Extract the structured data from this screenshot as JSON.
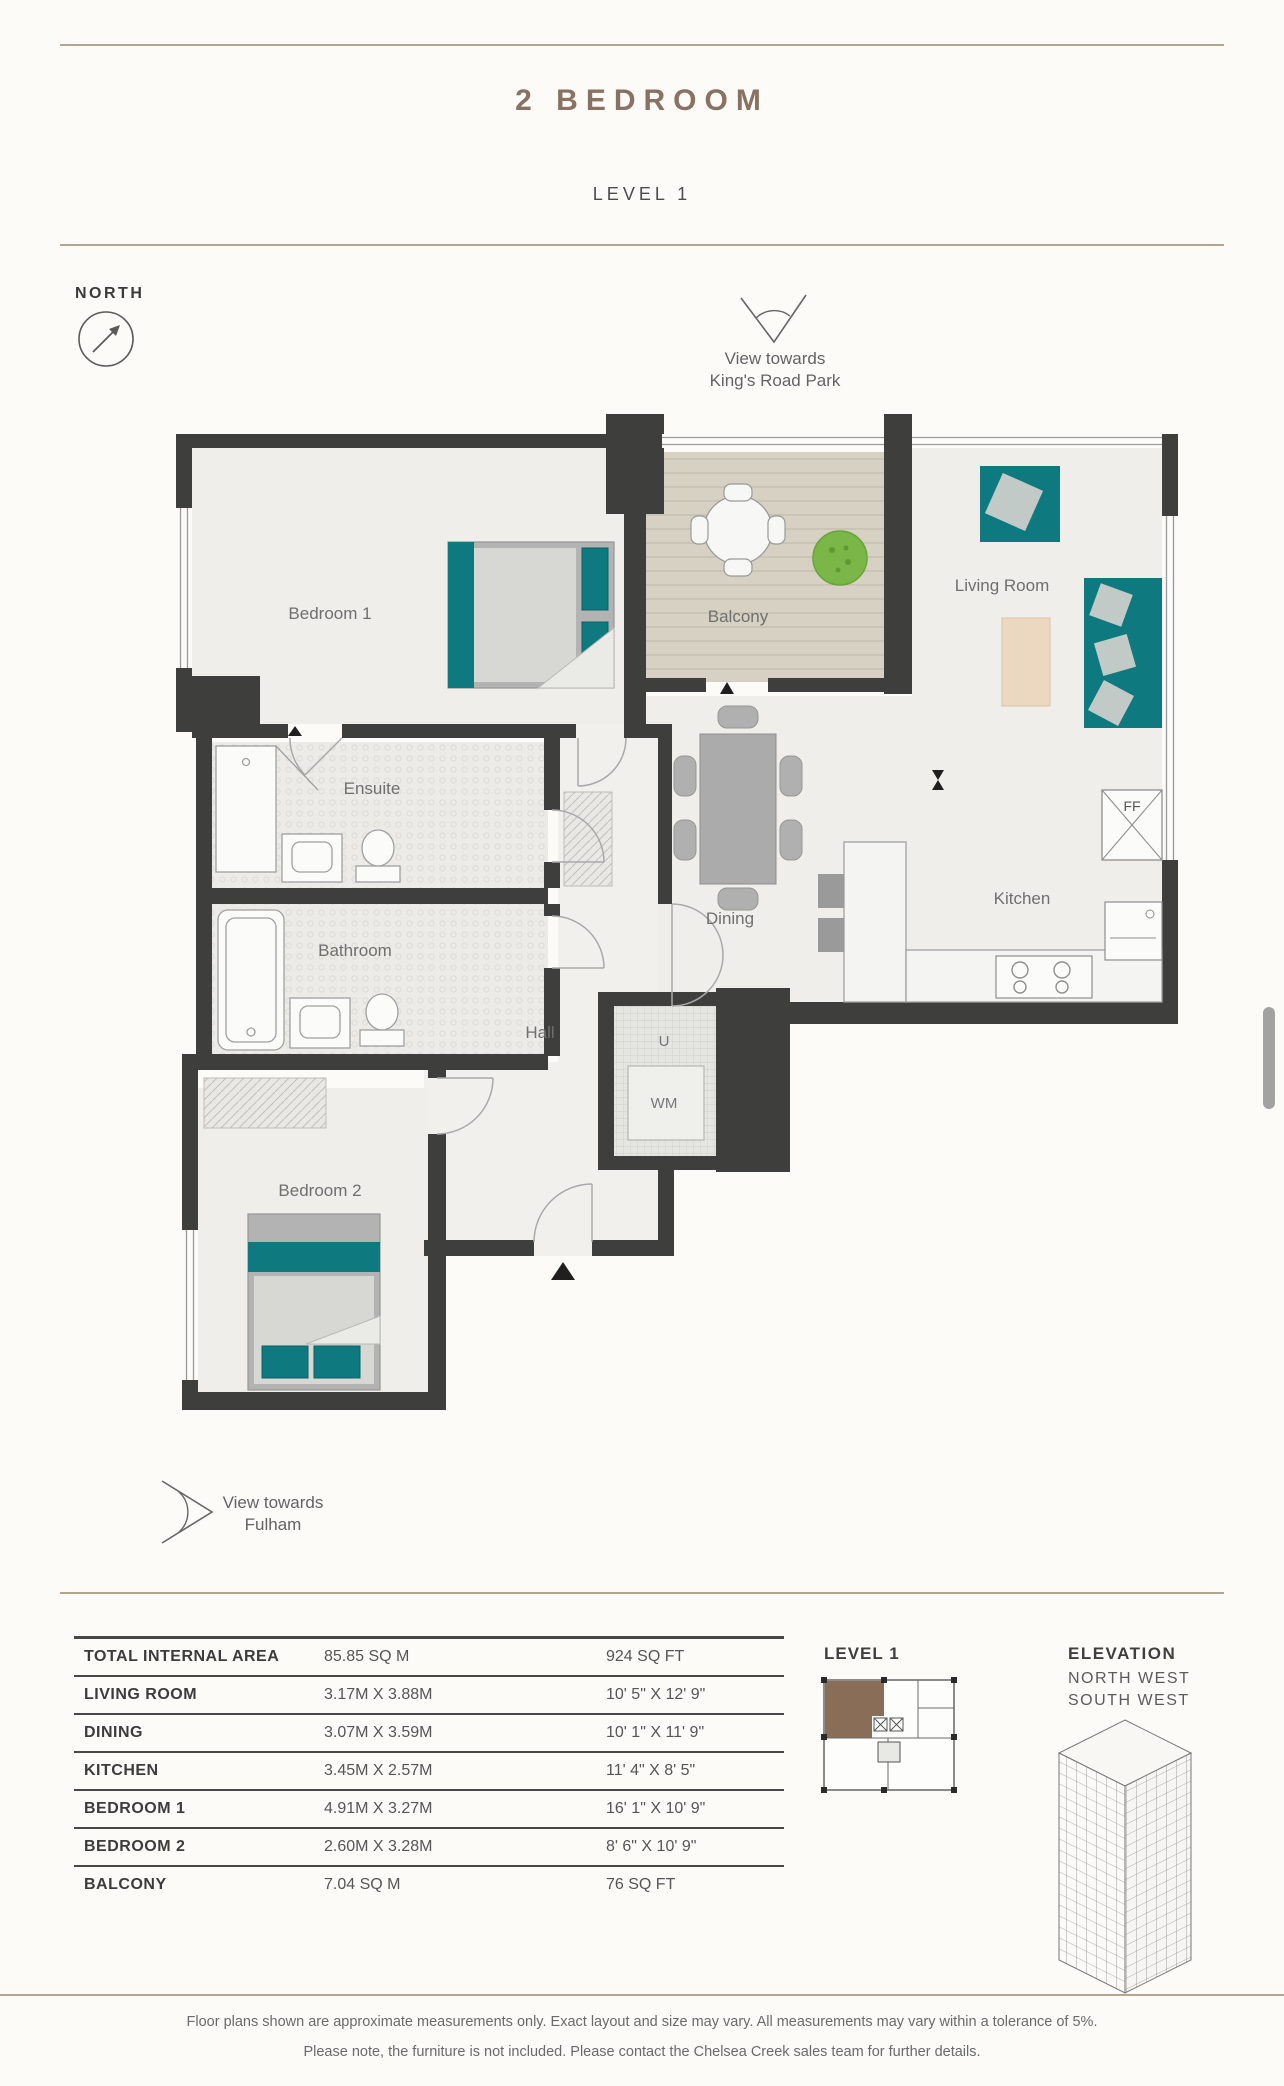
{
  "header": {
    "title": "2 BEDROOM",
    "subtitle": "LEVEL 1"
  },
  "compass": {
    "label": "NORTH"
  },
  "views": {
    "top": {
      "line1": "View towards",
      "line2": "King's Road Park"
    },
    "bottom": {
      "line1": "View towards",
      "line2": "Fulham"
    }
  },
  "plan": {
    "rooms": {
      "bedroom1": "Bedroom 1",
      "balcony": "Balcony",
      "living": "Living Room",
      "ensuite": "Ensuite",
      "bathroom": "Bathroom",
      "dining": "Dining",
      "kitchen": "Kitchen",
      "hall": "Hall",
      "bedroom2": "Bedroom 2"
    },
    "markers": {
      "ff": "FF",
      "u": "U",
      "wm": "WM"
    }
  },
  "table": {
    "rows": [
      {
        "label": "TOTAL INTERNAL AREA",
        "metric": "85.85 SQ M",
        "imperial": "924 SQ FT"
      },
      {
        "label": "LIVING ROOM",
        "metric": "3.17M X 3.88M",
        "imperial": "10' 5\" X 12' 9\""
      },
      {
        "label": "DINING",
        "metric": "3.07M X 3.59M",
        "imperial": "10' 1\" X 11' 9\""
      },
      {
        "label": "KITCHEN",
        "metric": "3.45M X 2.57M",
        "imperial": "11' 4\" X 8' 5\""
      },
      {
        "label": "BEDROOM 1",
        "metric": "4.91M X 3.27M",
        "imperial": "16' 1\" X 10' 9\""
      },
      {
        "label": "BEDROOM 2",
        "metric": "2.60M X 3.28M",
        "imperial": "8' 6\" X 10' 9\""
      },
      {
        "label": "BALCONY",
        "metric": "7.04 SQ M",
        "imperial": "76 SQ FT"
      }
    ]
  },
  "keyplan": {
    "title": "LEVEL 1"
  },
  "elevation": {
    "title": "ELEVATION",
    "line1": "NORTH WEST",
    "line2": "SOUTH WEST"
  },
  "footer": {
    "line1": "Floor plans shown are approximate measurements only. Exact layout and size may vary. All measurements may vary within a tolerance of 5%.",
    "line2": "Please note, the furniture is not included. Please contact the Chelsea Creek sales team for further details."
  },
  "colors": {
    "accent_brown": "#8a7263",
    "rule_tan": "#b2a593",
    "wall": "#3e3e3d",
    "floor": "#efeeeb",
    "deck": "#d6d1c2",
    "teal": "#0e7a80",
    "plant_green": "#7ab648",
    "keyplan_unit": "#8a6d57"
  }
}
